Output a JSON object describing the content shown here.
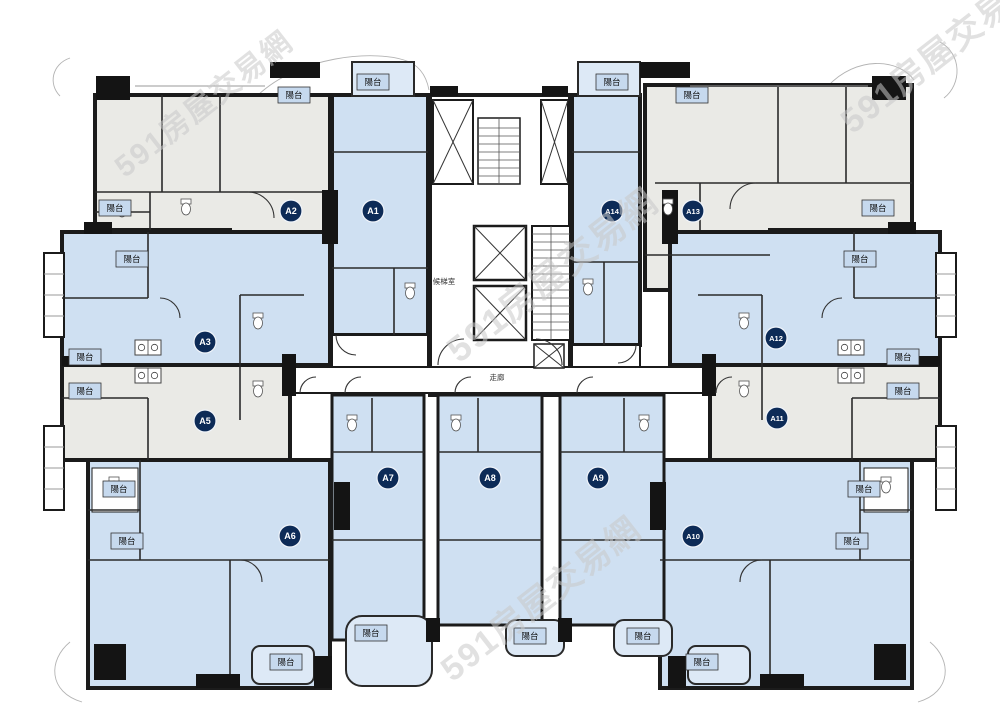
{
  "watermark": {
    "text": "591房屋交易網",
    "color": "#c9c9c9",
    "positions": [
      {
        "x": 210,
        "y": 112,
        "rot": -38,
        "size": 30
      },
      {
        "x": 948,
        "y": 60,
        "rot": -38,
        "size": 34
      },
      {
        "x": 560,
        "y": 285,
        "rot": -38,
        "size": 36
      },
      {
        "x": 548,
        "y": 608,
        "rot": -38,
        "size": 34
      }
    ]
  },
  "plan": {
    "balcony_label": "陽台",
    "elevator_hall": {
      "text": "候梯室",
      "x": 444,
      "y": 284
    },
    "corridor": {
      "text": "走廊",
      "x": 497,
      "y": 380
    },
    "colors": {
      "wall": "#1b1b1b",
      "room_blue": "#cfe0f2",
      "room_gray": "#eaeae6",
      "balcony_box": "#c6d9ee",
      "badge": "#0d2b57",
      "badge_text": "#ffffff"
    },
    "units": [
      {
        "id": "A2",
        "x": 291,
        "y": 211
      },
      {
        "id": "A1",
        "x": 373,
        "y": 211
      },
      {
        "id": "A14",
        "x": 612,
        "y": 211
      },
      {
        "id": "A13",
        "x": 693,
        "y": 211
      },
      {
        "id": "A3",
        "x": 205,
        "y": 342
      },
      {
        "id": "A12",
        "x": 776,
        "y": 338
      },
      {
        "id": "A5",
        "x": 205,
        "y": 421
      },
      {
        "id": "A11",
        "x": 777,
        "y": 418
      },
      {
        "id": "A7",
        "x": 388,
        "y": 478
      },
      {
        "id": "A8",
        "x": 490,
        "y": 478
      },
      {
        "id": "A9",
        "x": 598,
        "y": 478
      },
      {
        "id": "A6",
        "x": 290,
        "y": 536
      },
      {
        "id": "A10",
        "x": 693,
        "y": 536
      }
    ],
    "balconies": [
      {
        "x": 294,
        "y": 95
      },
      {
        "x": 373,
        "y": 82
      },
      {
        "x": 612,
        "y": 82
      },
      {
        "x": 692,
        "y": 95
      },
      {
        "x": 115,
        "y": 208
      },
      {
        "x": 878,
        "y": 208
      },
      {
        "x": 132,
        "y": 259
      },
      {
        "x": 860,
        "y": 259
      },
      {
        "x": 85,
        "y": 357
      },
      {
        "x": 903,
        "y": 357
      },
      {
        "x": 85,
        "y": 391
      },
      {
        "x": 903,
        "y": 391
      },
      {
        "x": 119,
        "y": 489
      },
      {
        "x": 864,
        "y": 489
      },
      {
        "x": 127,
        "y": 541
      },
      {
        "x": 852,
        "y": 541
      },
      {
        "x": 286,
        "y": 662
      },
      {
        "x": 371,
        "y": 633
      },
      {
        "x": 530,
        "y": 636
      },
      {
        "x": 643,
        "y": 636
      },
      {
        "x": 702,
        "y": 662
      }
    ]
  }
}
